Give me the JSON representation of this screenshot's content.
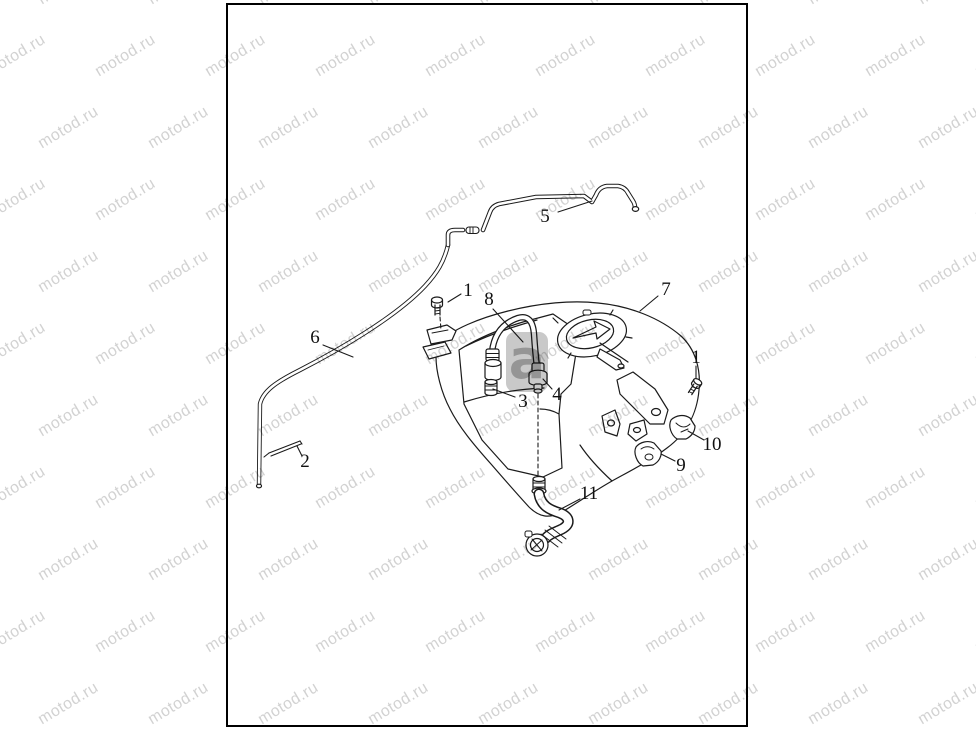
{
  "watermark": {
    "tile_text": "motod.ru",
    "logo_letter": "a",
    "tile_color": "#d2d2d2"
  },
  "colors": {
    "line": "#1b1b1b",
    "paper": "#ffffff",
    "border": "#000000"
  },
  "diagram": {
    "description": "fuel-tank-parts-diagram",
    "callouts": [
      {
        "label": "5",
        "x": 545,
        "y": 217,
        "leader": [
          558,
          212,
          592,
          201
        ]
      },
      {
        "label": "1",
        "x": 468,
        "y": 291,
        "leader": [
          461,
          294,
          448,
          302
        ]
      },
      {
        "label": "8",
        "x": 489,
        "y": 300,
        "leader": [
          493,
          309,
          523,
          342
        ]
      },
      {
        "label": "7",
        "x": 666,
        "y": 290,
        "leader": [
          658,
          296,
          640,
          311
        ]
      },
      {
        "label": "6",
        "x": 315,
        "y": 338,
        "leader": [
          323,
          345,
          353,
          357
        ]
      },
      {
        "label": "3",
        "x": 523,
        "y": 402,
        "leader": [
          515,
          397,
          493,
          389
        ]
      },
      {
        "label": "4",
        "x": 557,
        "y": 395,
        "leader": [
          552,
          389,
          543,
          379
        ]
      },
      {
        "label": "1",
        "x": 696,
        "y": 358,
        "leader": [
          696,
          366,
          696,
          378
        ]
      },
      {
        "label": "2",
        "x": 305,
        "y": 462,
        "leader": [
          302,
          456,
          297,
          446
        ]
      },
      {
        "label": "10",
        "x": 712,
        "y": 445,
        "leader": [
          704,
          440,
          688,
          431
        ]
      },
      {
        "label": "9",
        "x": 681,
        "y": 466,
        "leader": [
          675,
          461,
          661,
          454
        ]
      },
      {
        "label": "11",
        "x": 589,
        "y": 494,
        "leader": [
          580,
          499,
          559,
          510
        ]
      }
    ],
    "dashed_lines": [
      [
        440,
        317,
        441,
        330
      ],
      [
        538,
        394,
        538,
        476
      ]
    ]
  }
}
